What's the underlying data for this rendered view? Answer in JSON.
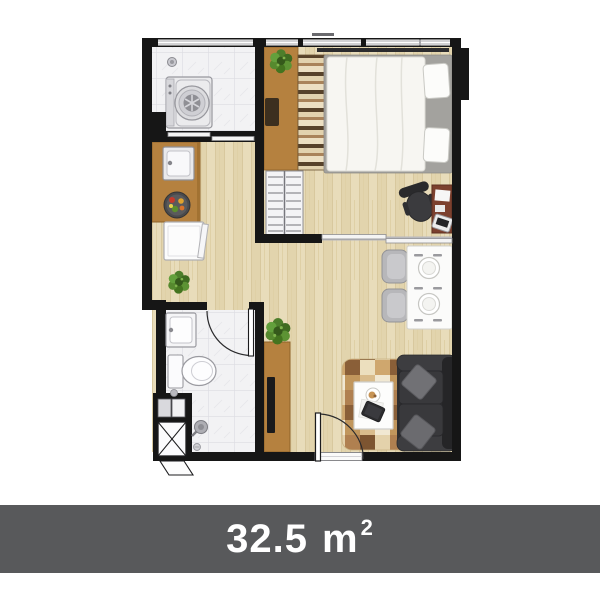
{
  "banner": {
    "area_value": "32.5",
    "area_unit": "m",
    "area_exponent": "2",
    "background": "#58595b",
    "text_color": "#ffffff"
  },
  "plan": {
    "colors": {
      "wall": "#161616",
      "wood-floor": "#e8dcba",
      "wood-grain": "#d8c89e",
      "tile-floor": "#f2f2f4",
      "tile-line": "#dcdce2",
      "counter-wood": "#b5813f",
      "counter-edge": "#8e6228",
      "sofa-dark": "#2e2e30",
      "plant-green": "#4c7d2a",
      "rug-tan": "#cfa76e",
      "bed-linen": "#f7f6f2",
      "banner-bg": "#58595b",
      "banner-text": "#ffffff"
    },
    "rooms": [
      {
        "name": "laundry",
        "icons": [
          "washing-machine-icon",
          "floor-drain-icon",
          "sliding-door-icon",
          "window-icon"
        ]
      },
      {
        "name": "kitchen",
        "icons": [
          "kitchen-counter-icon",
          "kitchen-sink-icon",
          "fruit-plate-icon",
          "refrigerator-icon",
          "plant-icon"
        ]
      },
      {
        "name": "bedroom",
        "icons": [
          "double-bed-icon",
          "pillow-icon",
          "wardrobe-rail-icon",
          "closet-shelf-icon",
          "desk-icon",
          "office-chair-icon",
          "laptop-icon",
          "plant-icon",
          "window-icon",
          "sliding-door-icon"
        ]
      },
      {
        "name": "bathroom",
        "icons": [
          "wash-basin-icon",
          "toilet-icon",
          "shower-head-icon",
          "floor-drain-icon",
          "door-icon"
        ]
      },
      {
        "name": "living-dining",
        "icons": [
          "dining-table-icon",
          "dining-chair-icon",
          "sofa-icon",
          "cushion-icon",
          "rug-icon",
          "coffee-table-icon",
          "tablet-icon",
          "tv-console-icon",
          "tv-icon",
          "plant-icon",
          "entrance-door-icon"
        ]
      },
      {
        "name": "service-shaft",
        "icons": [
          "duct-x-icon",
          "louver-flap-icon"
        ]
      }
    ]
  }
}
